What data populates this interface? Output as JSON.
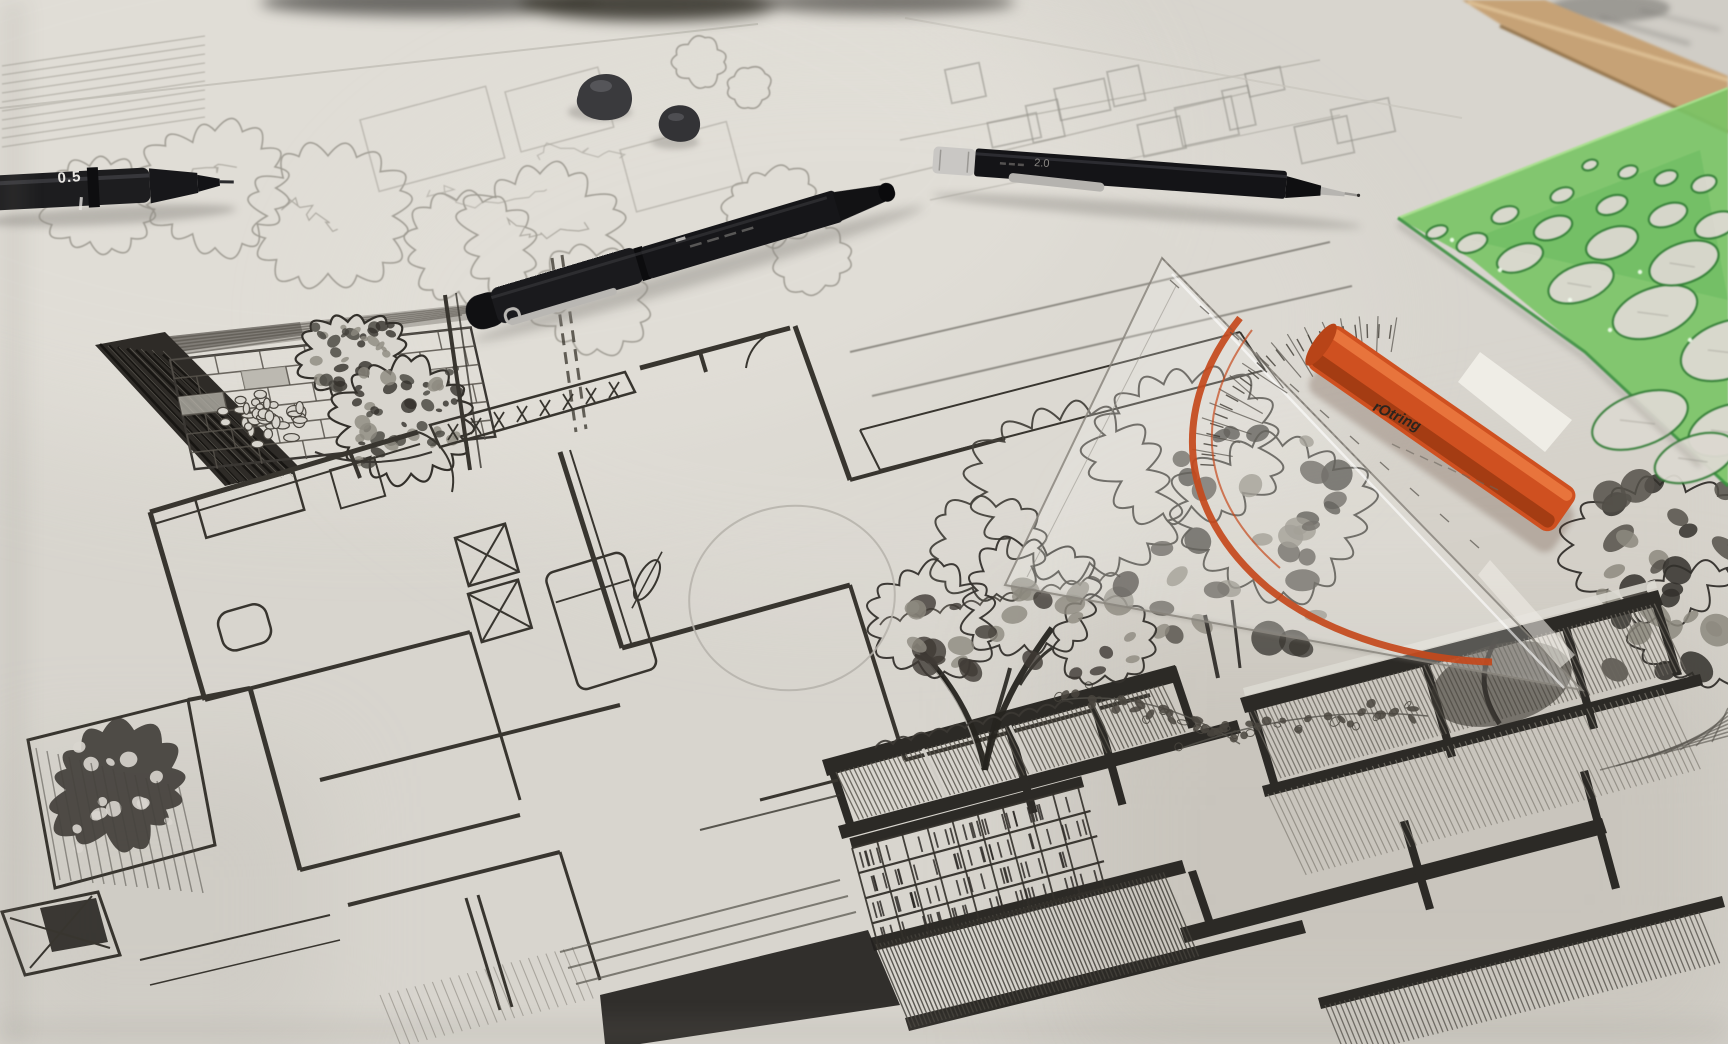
{
  "scene": {
    "type": "photograph",
    "description": "Hand-drawn architectural and landscape drawings in ink and pencil on a drafting table, photographed at an angle with drawing tools lying on the sheets",
    "paper_color": "#dcd9d2",
    "ink_color": "#38352f",
    "pencil_line_color": "#a09d94",
    "wood_edge_color": "#c6a276"
  },
  "tools": {
    "fineliner_pen": {
      "label": "black fineliner pen",
      "tip_size_label": "0.5",
      "body_color": "#1c1c1e"
    },
    "capped_pen": {
      "label": "black capped drawing pen",
      "body_color": "#17171a",
      "clip_color": "#b9b7b3"
    },
    "mechanical_pencil": {
      "label": "black mechanical pencil",
      "barrel_label": "2.0",
      "body_color": "#141417",
      "tip_color": "#b7b5b1"
    },
    "eraser_pieces": {
      "label": "kneaded eraser pieces",
      "count": 2,
      "color": "#3a3a3d"
    },
    "set_square": {
      "label": "rOtring geometry set square with protractor scale",
      "brand_label": "rOtring",
      "grip_color": "#cf5020",
      "scale_arc_color": "#c4491c"
    },
    "circle_template": {
      "label": "green circle template",
      "color": "#79c465"
    }
  },
  "drawings": {
    "top_left": "tree canopies in plan, pencil",
    "left_middle": "courtyard detail with wood deck, brick paving, pebbles and trees, ink",
    "center": "floor plan with walls, doors, stairs and furniture, ink",
    "top_right": "faint site plan massing sketch, pencil",
    "center_right": "tree elevation sketch, ink",
    "bottom": "building elevation with beams, glazing, bookshelves and planting, ink",
    "construction_circle": "light pencil construction circle"
  }
}
